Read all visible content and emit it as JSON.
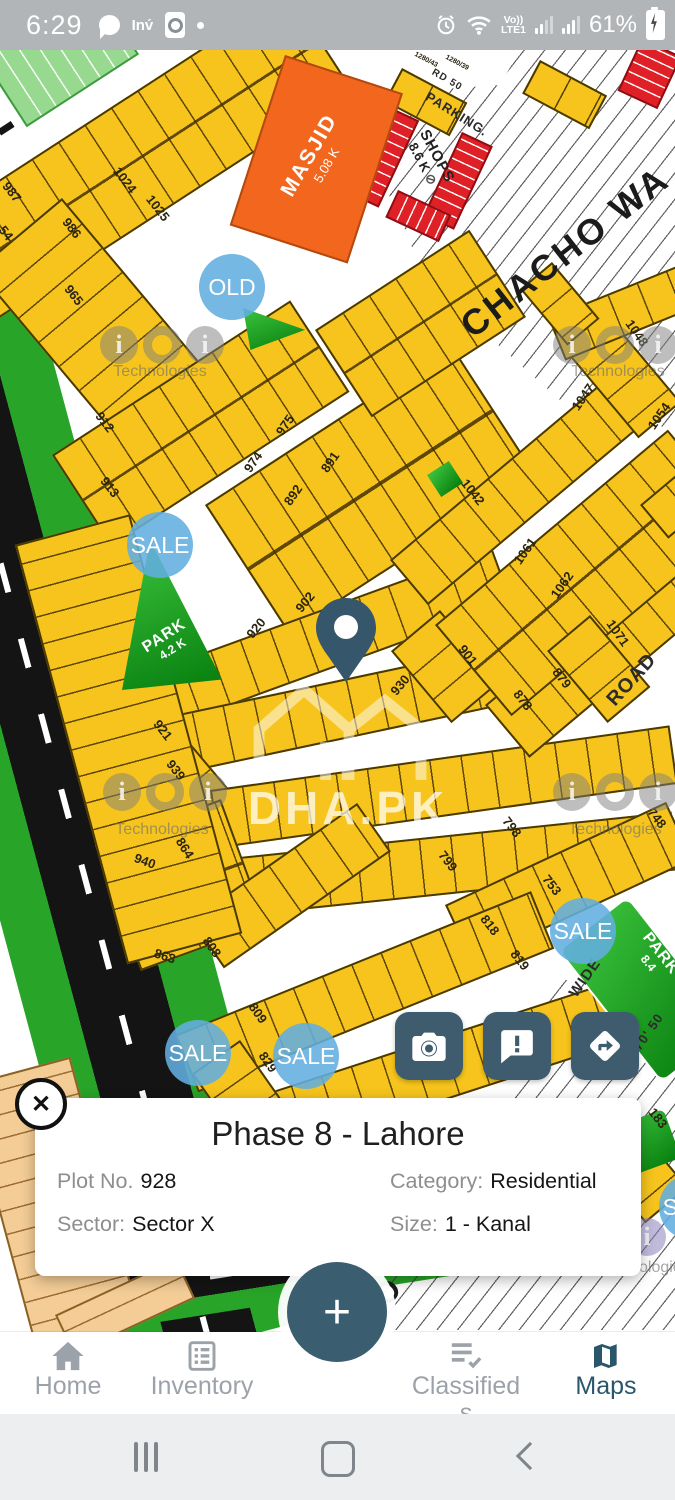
{
  "status_bar": {
    "time": "6:29",
    "inv": "Inv́",
    "volte_top": "Vo))",
    "volte_bottom": "LTE1",
    "battery": "61%"
  },
  "map": {
    "plot_labels": [
      {
        "t": "987",
        "x": 12,
        "y": 192,
        "r": 52
      },
      {
        "t": "54",
        "x": 6,
        "y": 233,
        "r": 52
      },
      {
        "t": "986",
        "x": 72,
        "y": 228,
        "r": 52
      },
      {
        "t": "965",
        "x": 74,
        "y": 295,
        "r": 52
      },
      {
        "t": "1024",
        "x": 125,
        "y": 180,
        "r": 52
      },
      {
        "t": "1025",
        "x": 158,
        "y": 208,
        "r": 52
      },
      {
        "t": "912",
        "x": 105,
        "y": 422,
        "r": 52
      },
      {
        "t": "913",
        "x": 110,
        "y": 487,
        "r": 52
      },
      {
        "t": "974",
        "x": 253,
        "y": 462,
        "r": -55
      },
      {
        "t": "975",
        "x": 285,
        "y": 425,
        "r": -55
      },
      {
        "t": "892",
        "x": 293,
        "y": 495,
        "r": -55
      },
      {
        "t": "891",
        "x": 330,
        "y": 462,
        "r": -55
      },
      {
        "t": "920",
        "x": 256,
        "y": 628,
        "r": -50
      },
      {
        "t": "902",
        "x": 305,
        "y": 602,
        "r": -50
      },
      {
        "t": "930",
        "x": 400,
        "y": 685,
        "r": -50
      },
      {
        "t": "921",
        "x": 163,
        "y": 730,
        "r": 52
      },
      {
        "t": "939",
        "x": 176,
        "y": 770,
        "r": 52
      },
      {
        "t": "940",
        "x": 145,
        "y": 861,
        "r": 20
      },
      {
        "t": "864",
        "x": 185,
        "y": 848,
        "r": 58
      },
      {
        "t": "863",
        "x": 165,
        "y": 956,
        "r": 18
      },
      {
        "t": "808",
        "x": 212,
        "y": 947,
        "r": 55
      },
      {
        "t": "809",
        "x": 258,
        "y": 1013,
        "r": 55
      },
      {
        "t": "829",
        "x": 268,
        "y": 1062,
        "r": 55
      },
      {
        "t": "798",
        "x": 512,
        "y": 827,
        "r": 52
      },
      {
        "t": "799",
        "x": 448,
        "y": 861,
        "r": 52
      },
      {
        "t": "753",
        "x": 552,
        "y": 885,
        "r": 52
      },
      {
        "t": "818",
        "x": 490,
        "y": 925,
        "r": 52
      },
      {
        "t": "819",
        "x": 520,
        "y": 960,
        "r": 52
      },
      {
        "t": "748",
        "x": 657,
        "y": 818,
        "r": 52
      },
      {
        "t": "183",
        "x": 658,
        "y": 1118,
        "r": 52
      },
      {
        "t": "901",
        "x": 468,
        "y": 655,
        "r": 52
      },
      {
        "t": "879",
        "x": 562,
        "y": 678,
        "r": 52
      },
      {
        "t": "878",
        "x": 523,
        "y": 700,
        "r": 52
      },
      {
        "t": "1042",
        "x": 473,
        "y": 492,
        "r": 52
      },
      {
        "t": "1047",
        "x": 583,
        "y": 397,
        "r": -55
      },
      {
        "t": "1048",
        "x": 637,
        "y": 333,
        "r": 55
      },
      {
        "t": "1054",
        "x": 659,
        "y": 416,
        "r": -55
      },
      {
        "t": "1061",
        "x": 525,
        "y": 551,
        "r": -55
      },
      {
        "t": "1062",
        "x": 562,
        "y": 585,
        "r": -55
      },
      {
        "t": "1071",
        "x": 618,
        "y": 633,
        "r": 55
      },
      {
        "t": "1280/43",
        "x": 426,
        "y": 60,
        "r": 28,
        "fs": 7
      },
      {
        "t": "1280/39",
        "x": 457,
        "y": 63,
        "r": 28,
        "fs": 7
      }
    ],
    "road_labels": [
      {
        "t": "CHACHO WA",
        "x": 565,
        "y": 252,
        "r": -38,
        "fs": 36,
        "cls": "big"
      },
      {
        "t": "HO",
        "x": 380,
        "y": 1300,
        "r": -40,
        "fs": 30,
        "cls": "big"
      },
      {
        "t": "ROAD",
        "x": 632,
        "y": 680,
        "r": -48,
        "fs": 20
      },
      {
        "t": "RD 50",
        "x": 447,
        "y": 80,
        "r": 30,
        "fs": 10
      },
      {
        "t": "WIDE",
        "x": 585,
        "y": 978,
        "r": -55,
        "fs": 15
      },
      {
        "t": "RD 70' 50",
        "x": 641,
        "y": 1042,
        "r": -55,
        "fs": 13
      }
    ],
    "markers": [
      {
        "t": "OLD",
        "x": 232,
        "y": 287
      },
      {
        "t": "SALE",
        "x": 160,
        "y": 545
      },
      {
        "t": "SALE",
        "x": 583,
        "y": 931
      },
      {
        "t": "SALE",
        "x": 198,
        "y": 1053
      },
      {
        "t": "SALE",
        "x": 306,
        "y": 1056
      },
      {
        "t": "SALE",
        "x": 692,
        "y": 1207
      }
    ],
    "masjid": {
      "name": "MASJID",
      "size": "5.08 K"
    },
    "shops": {
      "name": "SHOPS",
      "size": "8.6 K",
      "no_entry": "⊘"
    },
    "parking": "PARKING.",
    "parks": [
      {
        "name": "PARK",
        "size": "4.2 K"
      },
      {
        "name": "PARK",
        "size": "8.4"
      }
    ],
    "watermark_brand": "DHA.PK",
    "watermarks": [
      {
        "t": "Technologies",
        "x": 160,
        "y": 372
      },
      {
        "t": "Technologies",
        "x": 618,
        "y": 372
      },
      {
        "t": "Technologies",
        "x": 162,
        "y": 830
      },
      {
        "t": "Technologies",
        "x": 615,
        "y": 830
      },
      {
        "t": "Technologies",
        "x": 643,
        "y": 1268
      }
    ]
  },
  "action_buttons": [
    {
      "name": "camera"
    },
    {
      "name": "feedback"
    },
    {
      "name": "directions"
    }
  ],
  "info_card": {
    "title": "Phase 8 - Lahore",
    "fields": [
      {
        "label": "Plot No.",
        "value": "928"
      },
      {
        "label": "Category:",
        "value": "Residential"
      },
      {
        "label": "Sector:",
        "value": "Sector X"
      },
      {
        "label": "Size:",
        "value": "1 - Kanal"
      }
    ]
  },
  "fab": {
    "label": "+"
  },
  "bottom_nav": {
    "items": [
      {
        "label": "Home",
        "icon": "home-icon",
        "active": false
      },
      {
        "label": "Inventory",
        "icon": "inventory-icon",
        "active": false
      },
      {
        "label": "Classifieds",
        "icon": "classifieds-icon",
        "active": false
      },
      {
        "label": "Maps",
        "icon": "maps-icon",
        "active": true
      }
    ]
  },
  "android_nav": {
    "icons": [
      "recents-icon",
      "home-icon",
      "back-icon"
    ]
  }
}
